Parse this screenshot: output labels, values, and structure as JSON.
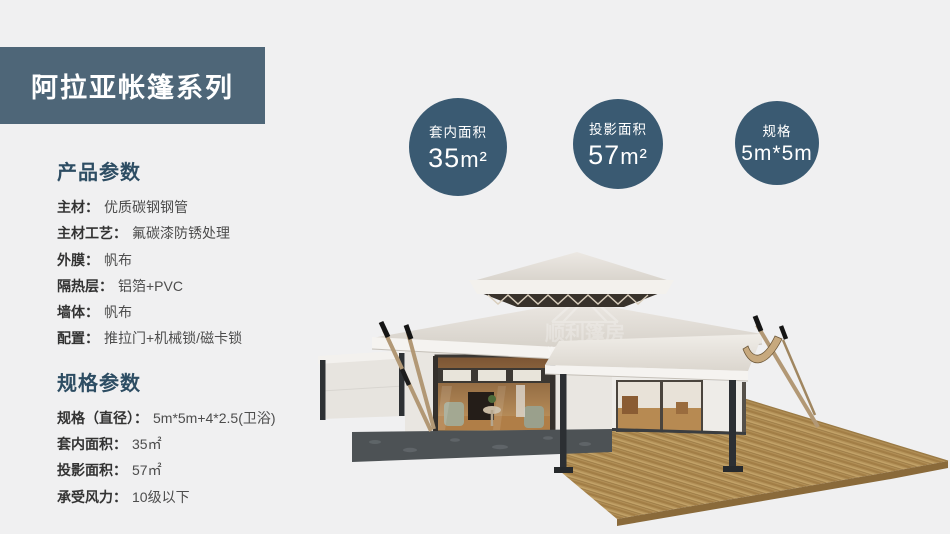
{
  "banner": {
    "title": "阿拉亚帐篷系列"
  },
  "colors": {
    "page_bg": "#f0f0f1",
    "banner_bg": "#4e6678",
    "badge_bg": "#3a5a72",
    "heading_text": "#2d4d63",
    "roof_canvas": "#e8e4de",
    "deck_wood": "#b39158"
  },
  "product_params": {
    "heading": "产品参数",
    "items": [
      {
        "label": "主材：",
        "value": "优质碳钢钢管"
      },
      {
        "label": "主材工艺：",
        "value": "氟碳漆防锈处理"
      },
      {
        "label": "外膜：",
        "value": "帆布"
      },
      {
        "label": "隔热层：",
        "value": "铝箔+PVC"
      },
      {
        "label": "墙体：",
        "value": "帆布"
      },
      {
        "label": "配置：",
        "value": "推拉门+机械锁/磁卡锁"
      }
    ]
  },
  "spec_params": {
    "heading": "规格参数",
    "items": [
      {
        "label": "规格（直径）：",
        "value": "5m*5m+4*2.5(卫浴)"
      },
      {
        "label": "套内面积：",
        "value": "35㎡"
      },
      {
        "label": "投影面积：",
        "value": "57㎡"
      },
      {
        "label": "承受风力：",
        "value": "10级以下"
      }
    ]
  },
  "badges": [
    {
      "label": "套内面积",
      "value": "35",
      "unit": "m²"
    },
    {
      "label": "投影面积",
      "value": "57",
      "unit": "m²"
    },
    {
      "label": "规格",
      "value": "5m*5m",
      "unit": ""
    }
  ],
  "watermark": {
    "text": "顺利篷房",
    "subtext": "WELL TENT"
  }
}
